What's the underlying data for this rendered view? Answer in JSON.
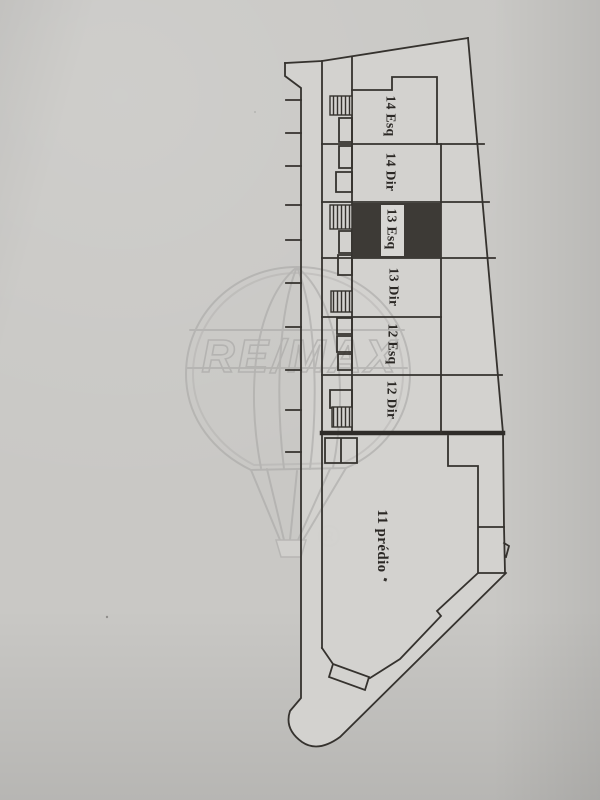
{
  "plan": {
    "units": [
      {
        "id": "14-esq",
        "label": "14 Esq",
        "highlighted": false
      },
      {
        "id": "14-dir",
        "label": "14 Dir",
        "highlighted": false
      },
      {
        "id": "13-esq",
        "label": "13 Esq",
        "highlighted": true
      },
      {
        "id": "13-dir",
        "label": "13 Dir",
        "highlighted": false
      },
      {
        "id": "12-esq",
        "label": "12 Esq",
        "highlighted": false
      },
      {
        "id": "12-dir",
        "label": "12 Dir",
        "highlighted": false
      },
      {
        "id": "11-predio",
        "label": "11 prédio",
        "highlighted": false
      }
    ],
    "colors": {
      "paper": "#c9c8c5",
      "plan_paper": "#d3d2cf",
      "line": "#35322e",
      "highlight_fill": "#3d3a36",
      "label_strip": "#d8d7d4"
    }
  },
  "watermark": {
    "brand": "RE/MAX",
    "registered_mark": "®",
    "color": "#a9a8a6"
  }
}
